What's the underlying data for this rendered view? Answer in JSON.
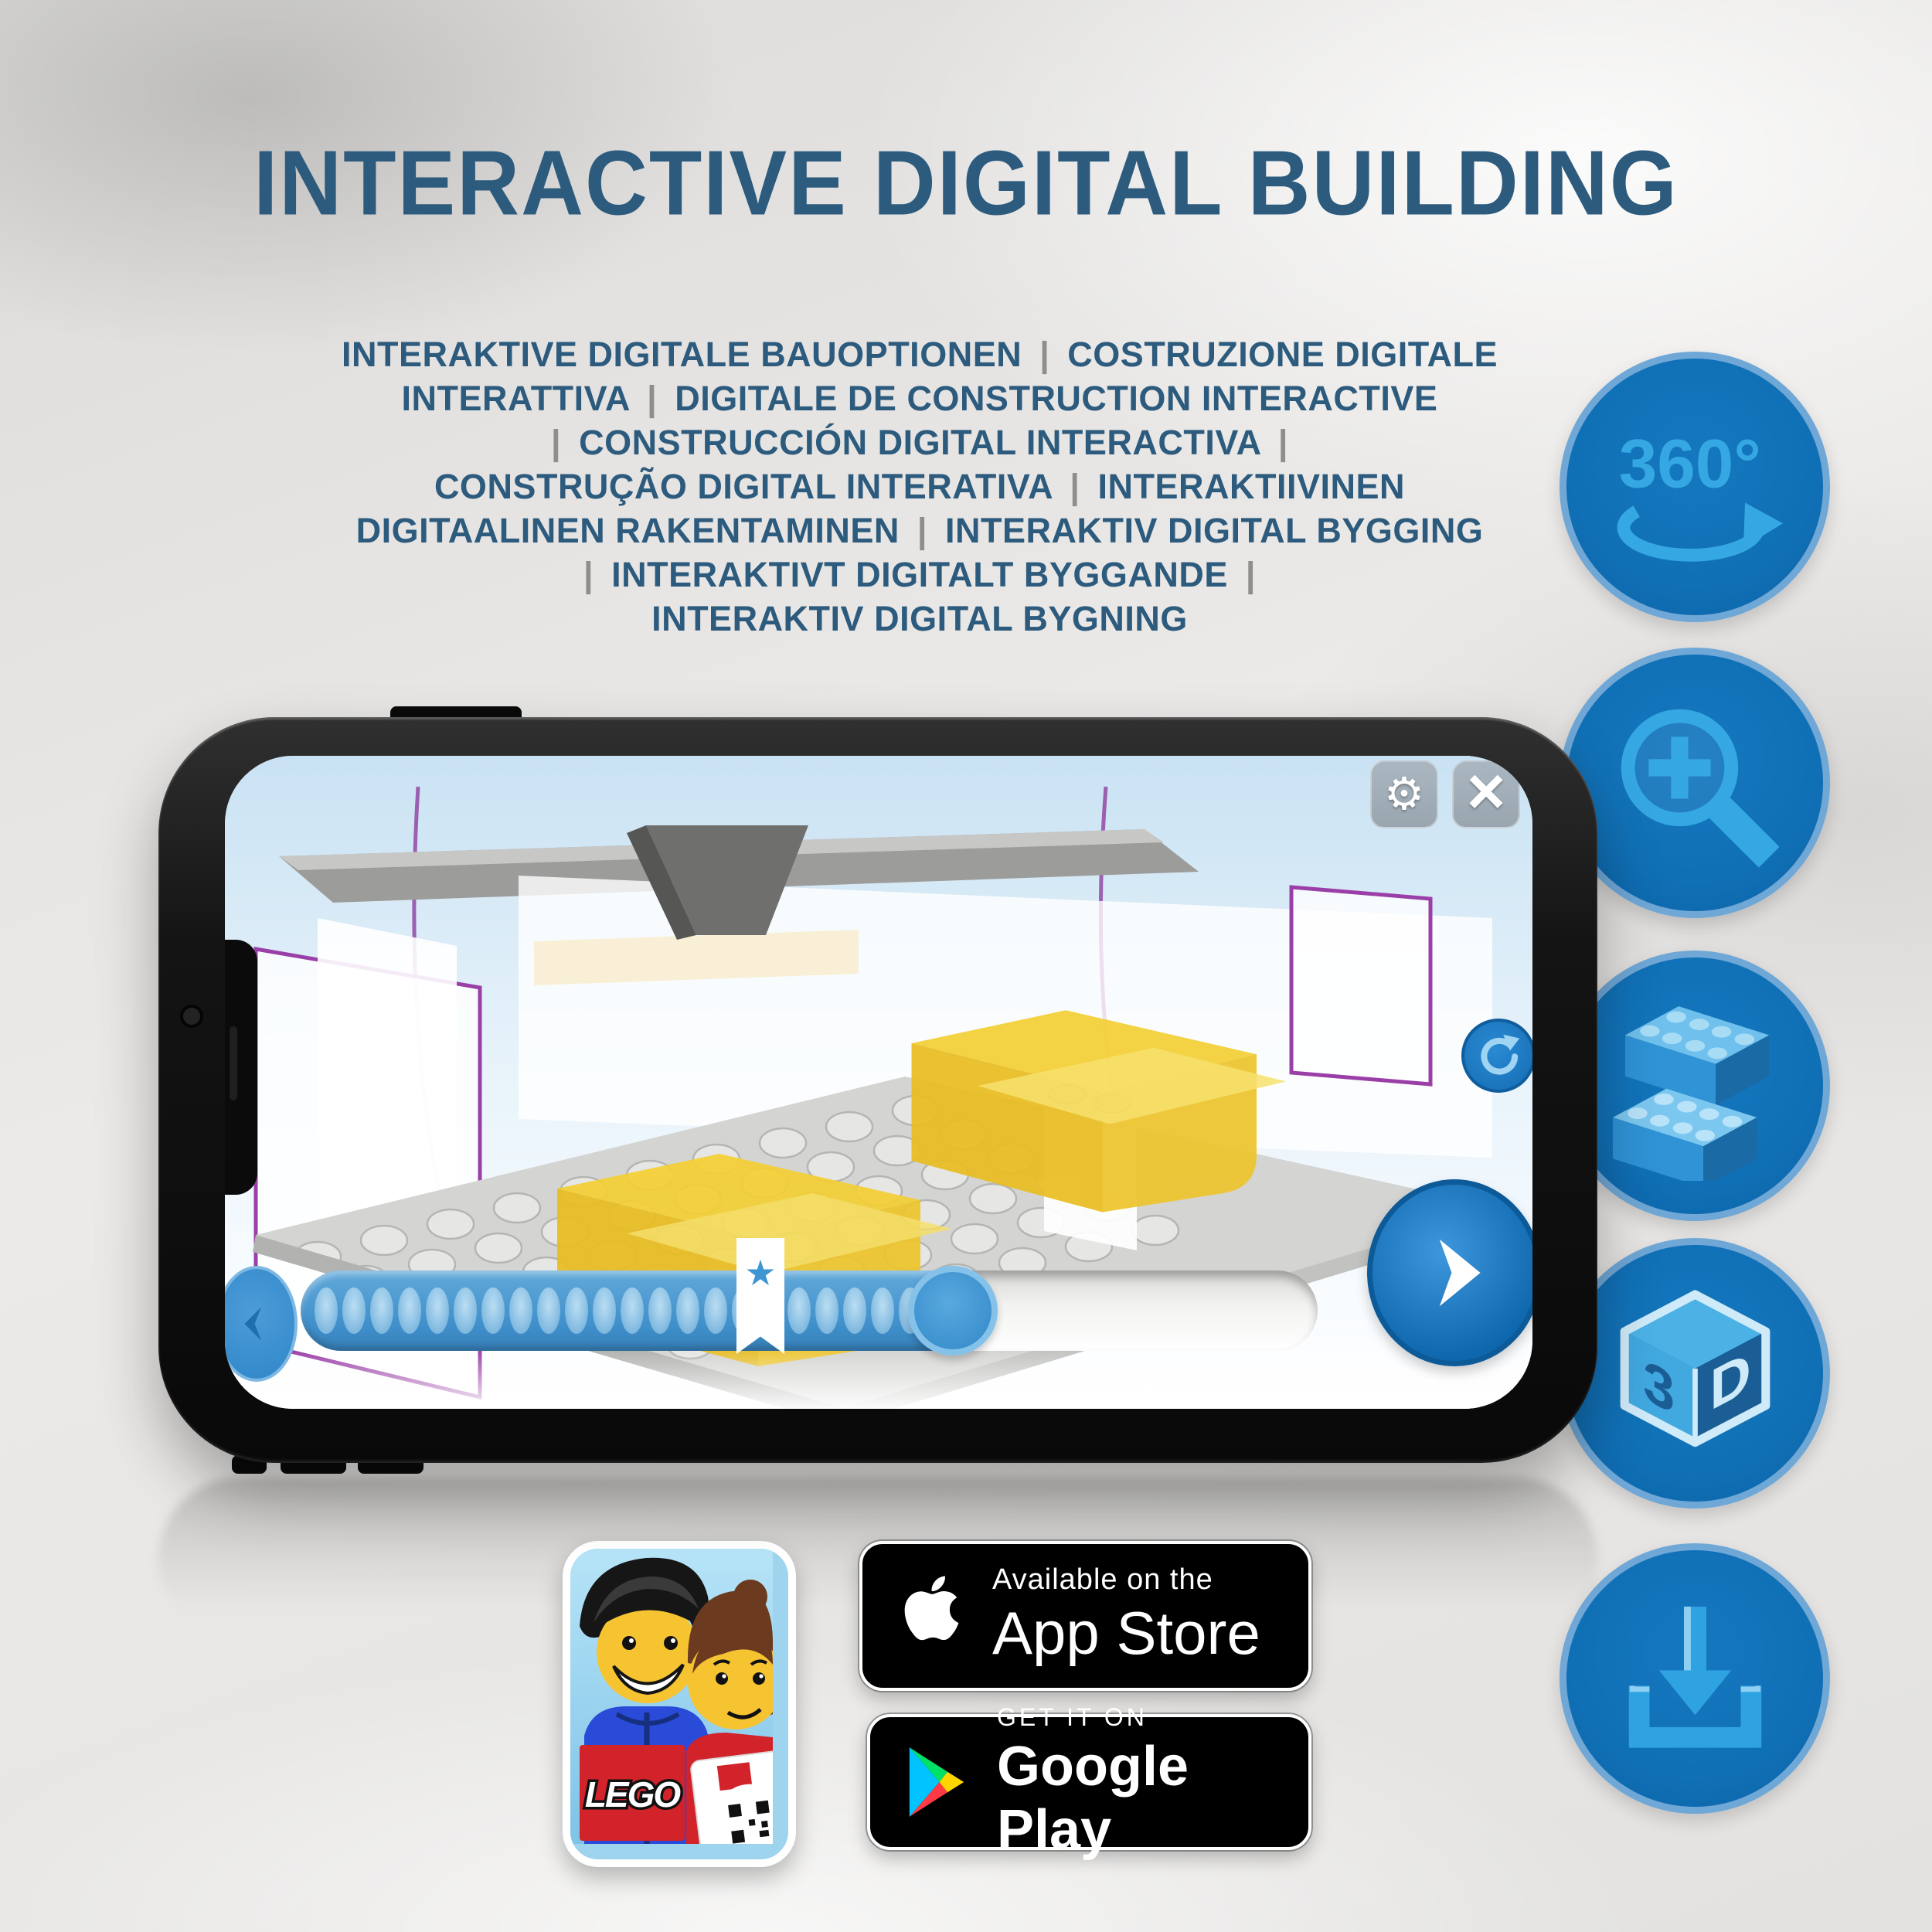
{
  "title": "INTERACTIVE DIGITAL BUILDING",
  "subtitle_lines": [
    "INTERAKTIVE DIGITALE BAUOPTIONEN | COSTRUZIONE DIGITALE",
    "INTERATTIVA | DIGITALE DE CONSTRUCTION INTERACTIVE",
    "| CONSTRUCCIÓN DIGITAL INTERACTIVA |",
    "CONSTRUÇÃO DIGITAL INTERATIVA | INTERAKTIIVINEN",
    "DIGITAALINEN RAKENTAMINEN | INTERAKTIV DIGITAL BYGGING",
    "| INTERAKTIVT DIGITALT BYGGANDE |",
    "INTERAKTIV DIGITAL BYGNING"
  ],
  "feature_icons": {
    "rotation_360": {
      "label": "360°"
    },
    "cube_3d": {
      "left_face": "3",
      "right_face": "D"
    }
  },
  "phone_screen": {
    "settings_glyph": "⚙",
    "close_glyph": "×",
    "star_marker": "★"
  },
  "app_icon": {
    "logo_text": "LEGO"
  },
  "badges": {
    "app_store": {
      "tagline": "Available on the",
      "store": "App Store"
    },
    "google_play": {
      "tagline": "GET IT ON",
      "store": "Google Play"
    }
  },
  "colors": {
    "heading": "#2d5b7e",
    "separator": "#8e8e8c",
    "icon_circle": "#1173b9",
    "icon_glyph": "#35a7e2",
    "badge_bg": "#000000",
    "lego_red": "#d2222a"
  }
}
